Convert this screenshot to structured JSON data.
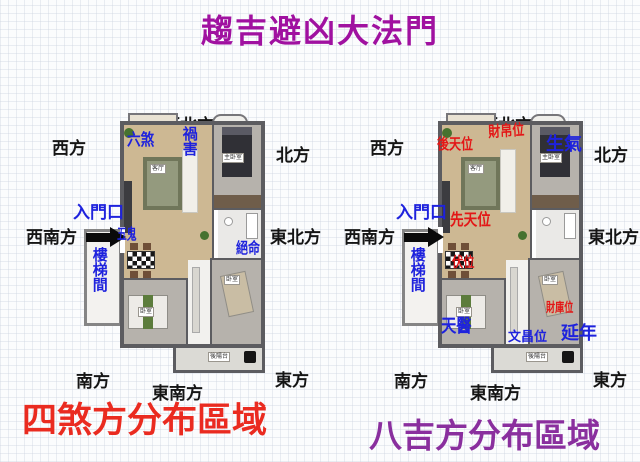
{
  "title": {
    "text": "趨吉避凶大法門",
    "color": "#a011a0"
  },
  "colors": {
    "annotation_blue": "#1e22dd",
    "annotation_red": "#e31717",
    "direction_label": "#151515",
    "caption_left_red": "#ea2b20",
    "caption_right_purple": "#8a2f9e",
    "wall": "#5c5c60",
    "entrance_arrow": "#0a0a0a"
  },
  "icons": {
    "entrance_arrow": "solid-black-right-arrow",
    "plant": "green-plant-dot"
  },
  "plans": [
    {
      "caption": {
        "text": "四煞方分布區域",
        "color": "#ea2b20"
      },
      "directions": [
        {
          "label": "西方"
        },
        {
          "label": "西北方"
        },
        {
          "label": "北方"
        },
        {
          "label": "西南方"
        },
        {
          "label": "東北方"
        },
        {
          "label": "南方"
        },
        {
          "label": "東南方"
        },
        {
          "label": "東方"
        }
      ],
      "annotations": [
        {
          "text": "六煞",
          "color": "#1e22dd"
        },
        {
          "text": "禍害",
          "color": "#1e22dd"
        },
        {
          "text": "入門口",
          "color": "#1e22dd"
        },
        {
          "text": "五鬼",
          "color": "#1e22dd"
        },
        {
          "text": "絕命",
          "color": "#1e22dd"
        },
        {
          "text": "樓梯間",
          "color": "#1e22dd"
        }
      ],
      "rooms": {
        "living": "客厅",
        "master": "主卧室",
        "bedroom1": "卧室",
        "bedroom2": "卧室",
        "balcony": "後陽台"
      }
    },
    {
      "caption": {
        "text": "八吉方分布區域",
        "color": "#8a2f9e"
      },
      "directions": [
        {
          "label": "西方"
        },
        {
          "label": "西北方"
        },
        {
          "label": "北方"
        },
        {
          "label": "西南方"
        },
        {
          "label": "東北方"
        },
        {
          "label": "南方"
        },
        {
          "label": "東南方"
        },
        {
          "label": "東方"
        }
      ],
      "annotations": [
        {
          "text": "後天位",
          "color": "#e31717"
        },
        {
          "text": "財帛位",
          "color": "#e31717"
        },
        {
          "text": "生氣",
          "color": "#1e22dd"
        },
        {
          "text": "入門口",
          "color": "#1e22dd"
        },
        {
          "text": "先天位",
          "color": "#e31717"
        },
        {
          "text": "伏位",
          "color": "#e31717"
        },
        {
          "text": "樓梯間",
          "color": "#1e22dd"
        },
        {
          "text": "天醫",
          "color": "#1e22dd"
        },
        {
          "text": "財庫位",
          "color": "#e31717"
        },
        {
          "text": "文昌位",
          "color": "#1e22dd"
        },
        {
          "text": "延年",
          "color": "#1e22dd"
        }
      ],
      "rooms": {
        "living": "客厅",
        "master": "主卧室",
        "bedroom1": "卧室",
        "bedroom2": "卧室",
        "balcony": "後陽台"
      }
    }
  ]
}
